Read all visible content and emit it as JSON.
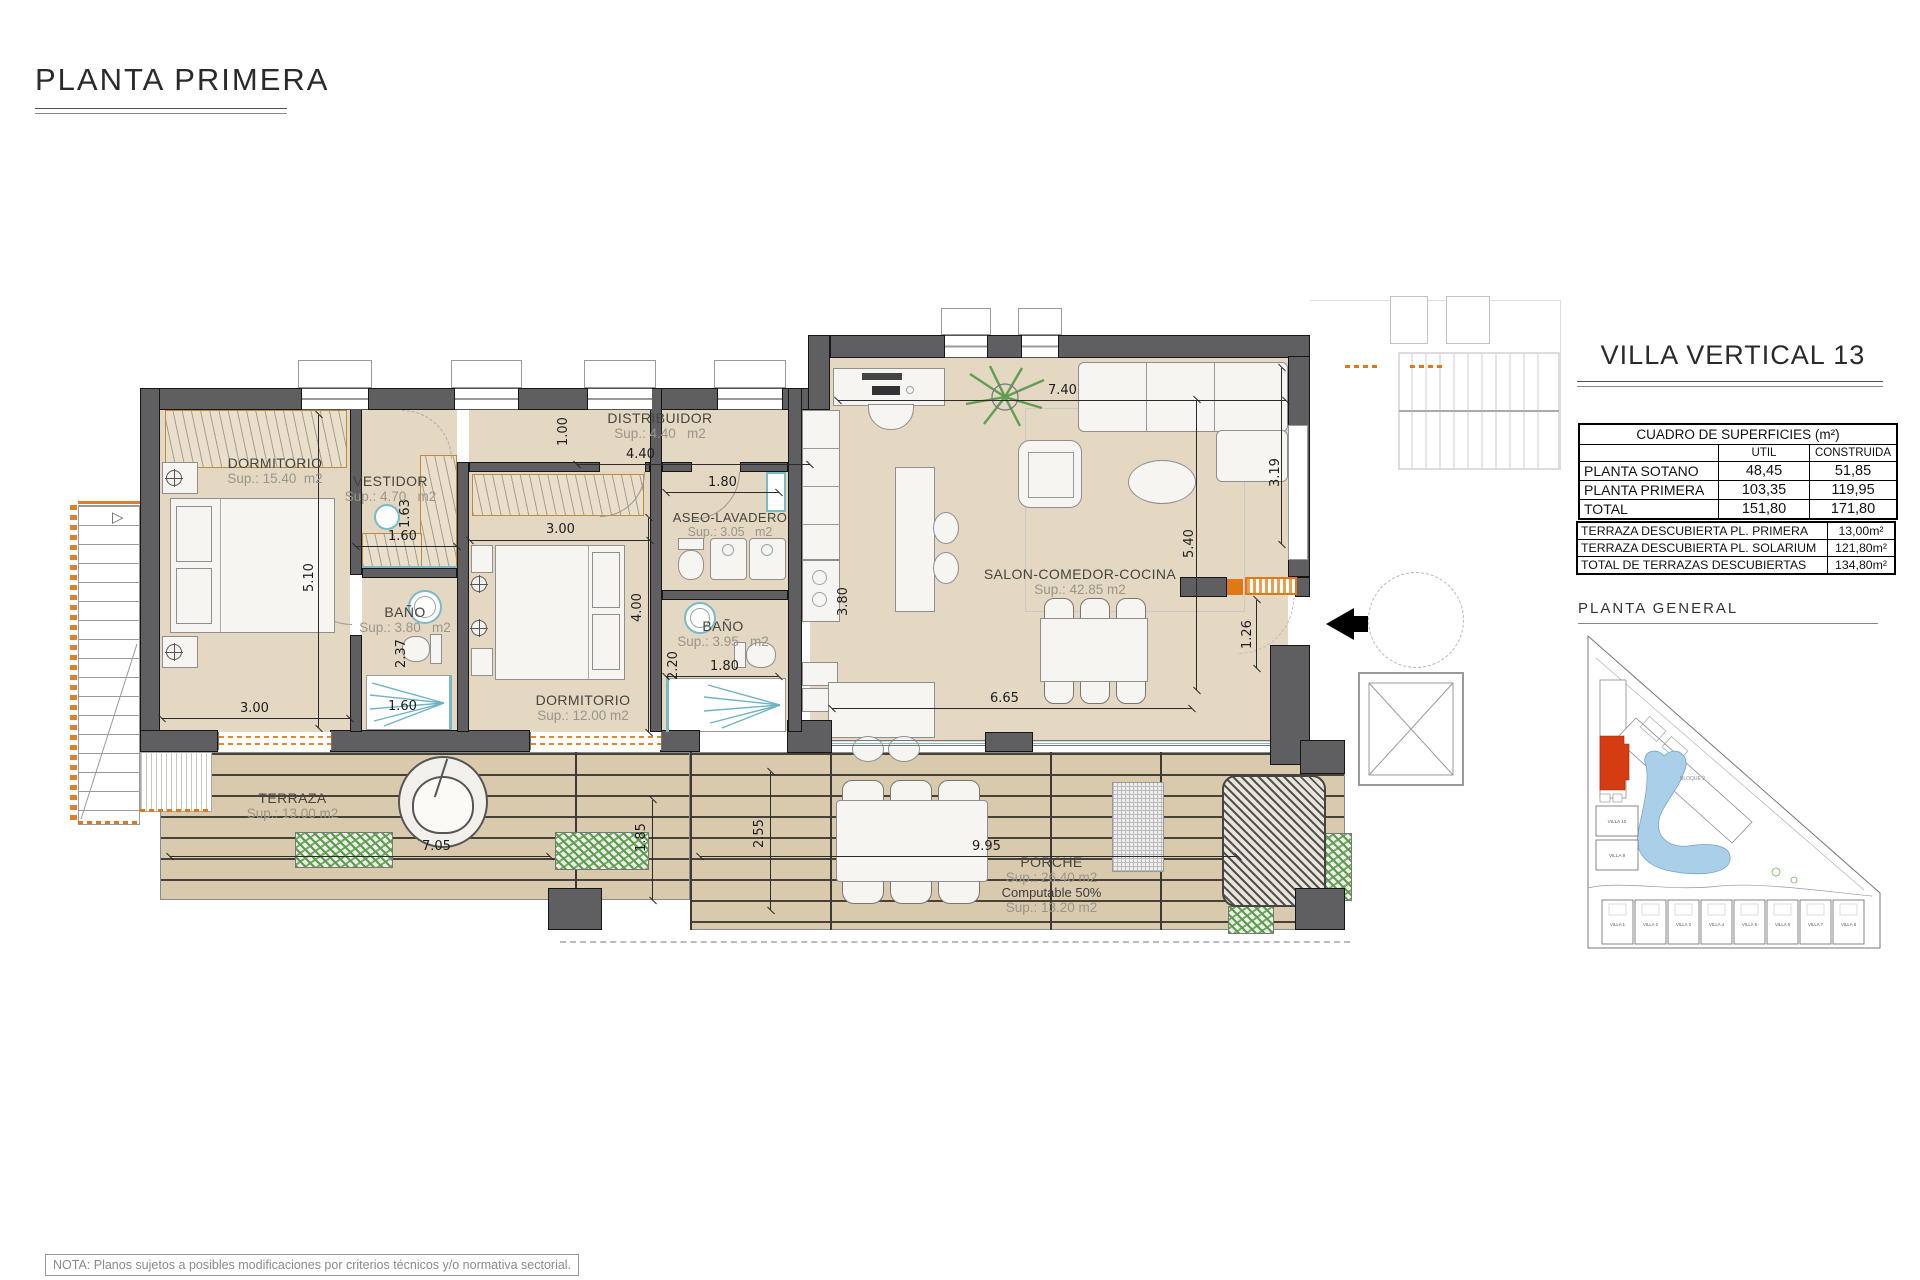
{
  "page": {
    "title": "PLANTA PRIMERA",
    "note": "NOTA: Planos sujetos a posibles modificaciones por criterios técnicos y/o normativa sectorial."
  },
  "panel": {
    "villa_title": "VILLA VERTICAL 13",
    "surfaces_table": {
      "title": "CUADRO DE SUPERFICIES (m²)",
      "col_util": "UTIL",
      "col_construida": "CONSTRUIDA",
      "rows": [
        {
          "label": "PLANTA SOTANO",
          "util": "48,45",
          "construida": "51,85"
        },
        {
          "label": "PLANTA PRIMERA",
          "util": "103,35",
          "construida": "119,95"
        },
        {
          "label": "TOTAL",
          "util": "151,80",
          "construida": "171,80"
        }
      ]
    },
    "terrace_table": {
      "rows": [
        {
          "label": "TERRAZA DESCUBIERTA PL. PRIMERA",
          "value": "13,00m²"
        },
        {
          "label": "TERRAZA DESCUBIERTA PL. SOLARIUM",
          "value": "121,80m²"
        },
        {
          "label": "TOTAL DE TERRAZAS DESCUBIERTAS",
          "value": "134,80m²"
        }
      ]
    },
    "site_plan": {
      "title": "PLANTA GENERAL",
      "bloque_label": "BLOQUE 2",
      "villas_left": [
        "VILLA 10",
        "VILLA 9"
      ],
      "villas_bottom": [
        "VILLA 1",
        "VILLA 2",
        "VILLA 3",
        "VILLA 4",
        "VILLA 5",
        "VILLA 6",
        "VILLA 7",
        "VILLA 8"
      ]
    }
  },
  "rooms": {
    "dormitorio1": {
      "name": "DORMITORIO",
      "sup": "Sup.: 15.40  m2"
    },
    "vestidor": {
      "name": "VESTIDOR",
      "sup": "Sup.: 4.70   m2"
    },
    "distribuidor": {
      "name": "DISTRIBUIDOR",
      "sup": "Sup.: 4.40   m2"
    },
    "aseo": {
      "name": "ASEO-LAVADERO",
      "sup": "Sup.: 3.05   m2"
    },
    "bano1": {
      "name": "BAÑO",
      "sup": "Sup.: 3.80   m2"
    },
    "bano2": {
      "name": "BAÑO",
      "sup": "Sup.: 3.95   m2"
    },
    "dormitorio2": {
      "name": "DORMITORIO",
      "sup": "Sup.: 12.00 m2"
    },
    "salon": {
      "name": "SALON-COMEDOR-COCINA",
      "sup": "Sup.: 42.85 m2"
    },
    "terraza": {
      "name": "TERRAZA",
      "sup": "Sup.: 13.00 m2"
    },
    "porche": {
      "name": "PORCHE",
      "sup": "Sup.: 26.40 m2",
      "computable": "Computable 50%",
      "computable_sup": "Sup.: 13.20 m2"
    }
  },
  "dimensions": {
    "d740": "7.40",
    "d440": "4.40",
    "d300a": "3.00",
    "d300b": "3.00",
    "d160a": "1.60",
    "d160b": "1.60",
    "d180a": "1.80",
    "d180b": "1.80",
    "d665": "6.65",
    "d995": "9.95",
    "d705": "7.05",
    "d510": "5.10",
    "d540": "5.40",
    "d400": "4.00",
    "d319": "3.19",
    "d126": "1.26",
    "d255": "2.55",
    "d185": "1.85",
    "d100": "1.00",
    "d163": "1.63",
    "d237": "2.37",
    "d220": "2.20",
    "d380": "3.80"
  }
}
